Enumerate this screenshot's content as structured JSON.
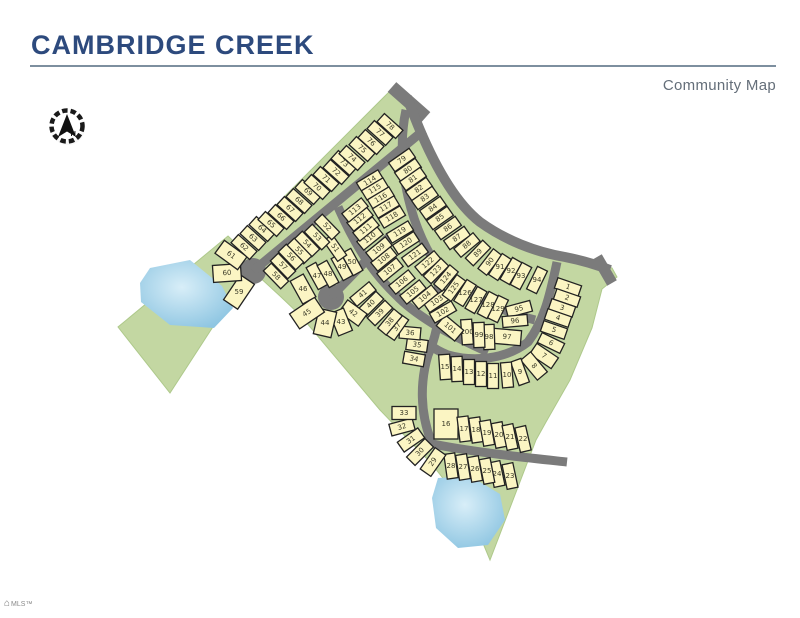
{
  "header": {
    "title": "CAMBRIDGE CREEK",
    "subtitle": "Community Map"
  },
  "compass": {
    "label": "N"
  },
  "footer": {
    "logo_text": "MLS™",
    "house_icon": "⌂"
  },
  "map": {
    "colors": {
      "green": "#c3d7a2",
      "green_edge": "#aec98b",
      "lot_fill": "#fbf5c3",
      "lot_stroke": "#222222",
      "road": "#7b7b7b",
      "pond_center": "#d8eef8",
      "pond_edge": "#8fc6e2",
      "number": "#3a3a28"
    },
    "green_areas": [
      "396,85 405,93 430,160 452,198 474,221 502,239 536,252 570,259 612,268 617,277 602,289 592,328 570,380 546,422 536,440 490,560 470,512 430,462 380,410 300,315 280,296 243,262 234,247",
      "228,236 255,262 170,393 118,327"
    ],
    "ponds": [
      "150,268 190,260 222,286 233,308 214,328 170,325 141,302 140,283",
      "438,478 470,476 500,494 505,520 488,545 458,548 436,528 432,498"
    ],
    "roads": [
      {
        "d": "M392,87 L426,117",
        "w": 13
      },
      {
        "d": "M407,97 C428,155 452,200 480,222 C505,240 535,252 565,257 C580,260 595,264 610,270",
        "w": 10
      },
      {
        "d": "M597,257 L612,283",
        "w": 11
      },
      {
        "d": "M253,271 L424,130",
        "w": 9
      },
      {
        "d": "M331,297 L389,237",
        "w": 9
      },
      {
        "d": "M406,110 C394,165 412,235 442,272 C466,294 500,311 535,320",
        "w": 9
      },
      {
        "d": "M338,207 C355,245 372,272 396,295 C417,317 452,336 488,352",
        "w": 9
      },
      {
        "d": "M557,262 C549,300 543,322 528,342 C505,360 472,362 448,355 C438,351 433,348 430,344",
        "w": 9
      },
      {
        "d": "M436,270 C442,300 440,328 428,355 C420,382 420,412 431,441",
        "w": 9
      },
      {
        "d": "M428,443 C470,452 530,458 567,462",
        "w": 9
      }
    ],
    "culdesacs": [
      [
        253,
        271,
        13
      ],
      [
        331,
        297,
        13
      ]
    ],
    "lot_default_size": [
      25,
      11
    ],
    "lot_sizes": {
      "7": [
        26,
        13
      ],
      "8": [
        26,
        13
      ],
      "16": [
        30,
        24
      ],
      "29": [
        26,
        13
      ],
      "30": [
        26,
        12
      ],
      "31": [
        25,
        12
      ],
      "32": [
        24,
        12
      ],
      "33": [
        24,
        13
      ],
      "34": [
        21,
        12
      ],
      "35": [
        21,
        12
      ],
      "36": [
        21,
        12
      ],
      "42": [
        24,
        15
      ],
      "43": [
        24,
        15
      ],
      "44": [
        26,
        18
      ],
      "45": [
        30,
        18
      ],
      "46": [
        26,
        15
      ],
      "59": [
        30,
        17
      ],
      "60": [
        28,
        17
      ],
      "61": [
        28,
        16
      ],
      "97": [
        28,
        15
      ],
      "101": [
        24,
        14
      ]
    },
    "lots": [
      [
        1,
        568,
        287,
        19
      ],
      [
        2,
        567,
        298,
        19
      ],
      [
        3,
        562,
        308,
        19
      ],
      [
        4,
        558,
        318,
        19
      ],
      [
        5,
        554,
        330,
        19
      ],
      [
        6,
        551,
        343,
        26
      ],
      [
        7,
        544,
        356,
        34
      ],
      [
        8,
        534,
        366,
        50
      ],
      [
        9,
        520,
        372,
        70
      ],
      [
        10,
        507,
        375,
        85
      ],
      [
        11,
        493,
        376,
        90
      ],
      [
        12,
        481,
        374,
        90
      ],
      [
        13,
        469,
        372,
        90
      ],
      [
        14,
        457,
        369,
        88
      ],
      [
        15,
        445,
        367,
        86
      ],
      [
        16,
        446,
        424,
        90
      ],
      [
        17,
        464,
        429,
        83
      ],
      [
        18,
        476,
        430,
        82
      ],
      [
        19,
        487,
        433,
        80
      ],
      [
        20,
        499,
        435,
        79
      ],
      [
        21,
        510,
        437,
        78
      ],
      [
        22,
        523,
        439,
        77
      ],
      [
        23,
        510,
        476,
        78
      ],
      [
        24,
        497,
        474,
        78
      ],
      [
        25,
        487,
        471,
        79
      ],
      [
        26,
        475,
        469,
        80
      ],
      [
        27,
        463,
        467,
        81
      ],
      [
        28,
        451,
        466,
        82
      ],
      [
        29,
        433,
        462,
        -55
      ],
      [
        30,
        420,
        452,
        -45
      ],
      [
        31,
        411,
        440,
        -35
      ],
      [
        32,
        402,
        427,
        -15
      ],
      [
        33,
        404,
        413,
        0
      ],
      [
        34,
        414,
        359,
        10
      ],
      [
        35,
        417,
        345,
        8
      ],
      [
        36,
        410,
        333,
        5
      ],
      [
        37,
        397,
        327,
        -55
      ],
      [
        38,
        390,
        322,
        -50
      ],
      [
        39,
        380,
        313,
        -45
      ],
      [
        40,
        371,
        304,
        -45
      ],
      [
        41,
        363,
        294,
        -40
      ],
      [
        42,
        353,
        313,
        36
      ],
      [
        43,
        341,
        322,
        68
      ],
      [
        44,
        325,
        323,
        -77
      ],
      [
        45,
        307,
        313,
        -34
      ],
      [
        46,
        303,
        289,
        61
      ],
      [
        47,
        317,
        276,
        61
      ],
      [
        48,
        328,
        274,
        61
      ],
      [
        49,
        342,
        267,
        61
      ],
      [
        50,
        352,
        262,
        61
      ],
      [
        51,
        335,
        248,
        55
      ],
      [
        52,
        327,
        227,
        46
      ],
      [
        53,
        317,
        237,
        46
      ],
      [
        54,
        307,
        244,
        46
      ],
      [
        55,
        299,
        251,
        46
      ],
      [
        56,
        291,
        257,
        46
      ],
      [
        57,
        283,
        266,
        46
      ],
      [
        58,
        276,
        276,
        46
      ],
      [
        59,
        239,
        292,
        -56
      ],
      [
        60,
        227,
        273,
        -4
      ],
      [
        61,
        231,
        255,
        36
      ],
      [
        62,
        244,
        247,
        42
      ],
      [
        63,
        253,
        238,
        42
      ],
      [
        64,
        262,
        229,
        42
      ],
      [
        65,
        271,
        224,
        42
      ],
      [
        66,
        281,
        217,
        42
      ],
      [
        67,
        290,
        209,
        42
      ],
      [
        68,
        299,
        201,
        42
      ],
      [
        69,
        308,
        192,
        42
      ],
      [
        70,
        317,
        187,
        42
      ],
      [
        71,
        326,
        179,
        42
      ],
      [
        72,
        336,
        172,
        42
      ],
      [
        73,
        344,
        163,
        42
      ],
      [
        74,
        352,
        158,
        42
      ],
      [
        75,
        362,
        149,
        42
      ],
      [
        76,
        371,
        142,
        42
      ],
      [
        77,
        380,
        133,
        42
      ],
      [
        78,
        390,
        126,
        42
      ],
      [
        79,
        402,
        160,
        -35
      ],
      [
        80,
        408,
        170,
        -35
      ],
      [
        81,
        413,
        179,
        -35
      ],
      [
        82,
        419,
        189,
        -35
      ],
      [
        83,
        425,
        198,
        -35
      ],
      [
        84,
        433,
        208,
        -35
      ],
      [
        85,
        440,
        218,
        -35
      ],
      [
        86,
        448,
        228,
        -35
      ],
      [
        87,
        457,
        238,
        -35
      ],
      [
        88,
        467,
        245,
        -40
      ],
      [
        89,
        478,
        253,
        -46
      ],
      [
        90,
        490,
        262,
        -52
      ],
      [
        91,
        500,
        267,
        -57
      ],
      [
        92,
        511,
        271,
        -60
      ],
      [
        93,
        521,
        276,
        -62
      ],
      [
        94,
        537,
        280,
        -64
      ],
      [
        95,
        519,
        309,
        -15
      ],
      [
        96,
        515,
        321,
        -5
      ],
      [
        97,
        507,
        337,
        5
      ],
      [
        98,
        489,
        337,
        88
      ],
      [
        99,
        479,
        335,
        88
      ],
      [
        100,
        467,
        332,
        86
      ],
      [
        101,
        450,
        328,
        40
      ],
      [
        102,
        443,
        312,
        -30
      ],
      [
        103,
        437,
        301,
        -34
      ],
      [
        104,
        425,
        297,
        -39
      ],
      [
        105,
        413,
        292,
        -39
      ],
      [
        106,
        402,
        282,
        -39
      ],
      [
        107,
        390,
        270,
        -39
      ],
      [
        108,
        384,
        259,
        -39
      ],
      [
        109,
        379,
        249,
        -39
      ],
      [
        110,
        370,
        238,
        -39
      ],
      [
        111,
        366,
        229,
        -39
      ],
      [
        112,
        360,
        219,
        -39
      ],
      [
        113,
        355,
        210,
        -39
      ],
      [
        114,
        370,
        181,
        -31
      ],
      [
        115,
        375,
        189,
        -31
      ],
      [
        116,
        381,
        198,
        -31
      ],
      [
        117,
        386,
        207,
        -31
      ],
      [
        118,
        392,
        217,
        -31
      ],
      [
        119,
        400,
        232,
        -31
      ],
      [
        120,
        406,
        243,
        -33
      ],
      [
        121,
        415,
        255,
        -36
      ],
      [
        122,
        428,
        263,
        -40
      ],
      [
        123,
        436,
        271,
        -45
      ],
      [
        124,
        446,
        278,
        -50
      ],
      [
        125,
        454,
        288,
        -54
      ],
      [
        126,
        465,
        293,
        -58
      ],
      [
        127,
        476,
        300,
        -60
      ],
      [
        128,
        488,
        305,
        -62
      ],
      [
        129,
        498,
        309,
        -64
      ]
    ]
  }
}
